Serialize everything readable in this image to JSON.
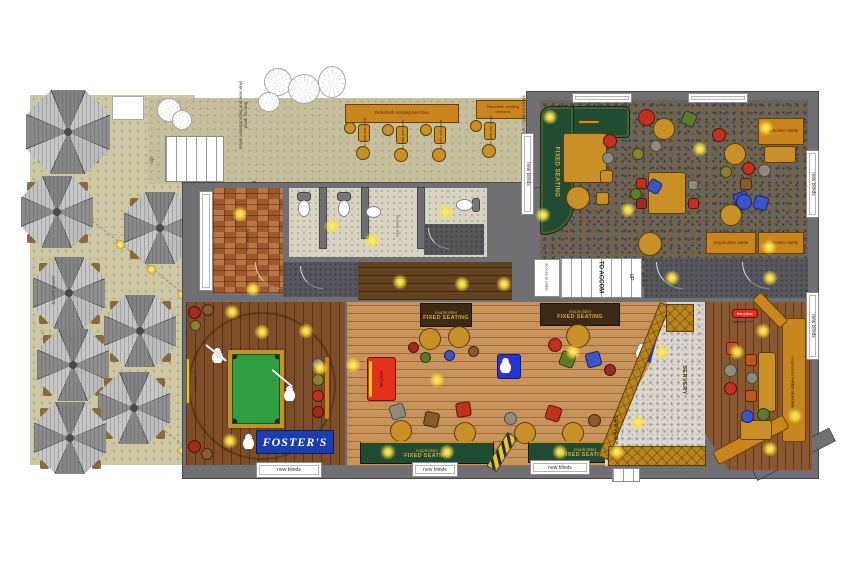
{
  "labels": {
    "refurbish_benches": "Refurbish existing benches",
    "new_table_stools": "New table and stools",
    "mural_note": "Mural on wall Crafts by CB",
    "retain_note": "retain waterproofing and new vinyl plank flooring",
    "paving": "paving",
    "bound_gravel": "bound gravel",
    "up": "up",
    "to_accom": "TO ACCOM",
    "up_caps": "UP",
    "cellar_note": "access to cellar",
    "fixed_seating": "FIXED SEATING",
    "reupholster": "reupholster",
    "settle": "reupholster settle",
    "new_blinds": "new blinds",
    "servery": "SERVERY",
    "fosters": "FOSTER'S",
    "fire_place": "fire place",
    "remove_tv": "remove TV",
    "relocated_tv": "relocated TV",
    "new_flooring": "new flooring",
    "bar_note": "new bar front here and shift out"
  },
  "colors": {
    "wall": "#6f6f74",
    "terrace": "#c5bf9c",
    "garden": "#cdc7a4",
    "lounge_carpet": "#6d6550",
    "games_wood": "#7d4e28",
    "bar_wood": "#c9945c",
    "snug_wood": "#8a5731",
    "entrance_tile": "#b06a3a",
    "wc_floor": "#d9d3c2",
    "banquette_green": "#1f4c32",
    "bench_gold": "#b8851f",
    "table_gold": "#c99027",
    "accent_red": "#e33018",
    "fosters_blue": "#1c3dae",
    "pool_green": "#2f9e42",
    "light_glow": "#ffe94a"
  }
}
